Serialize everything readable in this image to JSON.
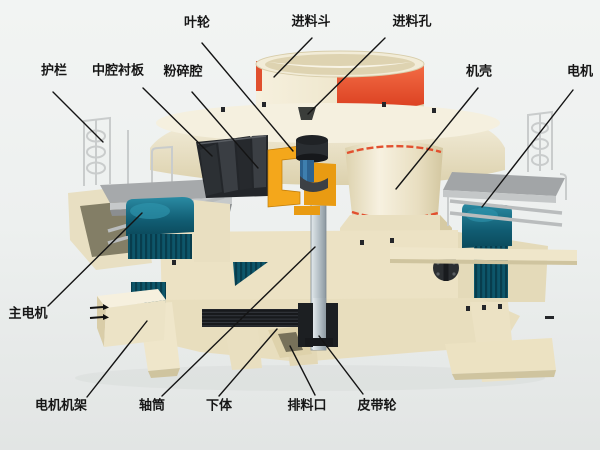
{
  "diagram": {
    "type": "labeled-cutaway-machine-diagram",
    "labels": {
      "impeller": "叶轮",
      "feed_hopper": "进料斗",
      "feed_inlet": "进料孔",
      "guardrail": "护栏",
      "middle_cavity_liner": "中腔衬板",
      "crushing_chamber": "粉碎腔",
      "casing": "机壳",
      "motor": "电机",
      "main_motor": "主电机",
      "motor_frame": "电机机架",
      "shaft_sleeve": "轴筒",
      "lower_body": "下体",
      "discharge_port": "排料口",
      "belt_pulley": "皮带轮"
    },
    "colors": {
      "background": "#edf0ef",
      "machine_cream": "#efe8cd",
      "hopper_band_red": "#e0482a",
      "impeller_orange": "#f2a41c",
      "motor_teal": "#11617a",
      "dark_metal": "#232629",
      "platform_gray": "#a3a6a8",
      "label_text": "#161616"
    }
  }
}
